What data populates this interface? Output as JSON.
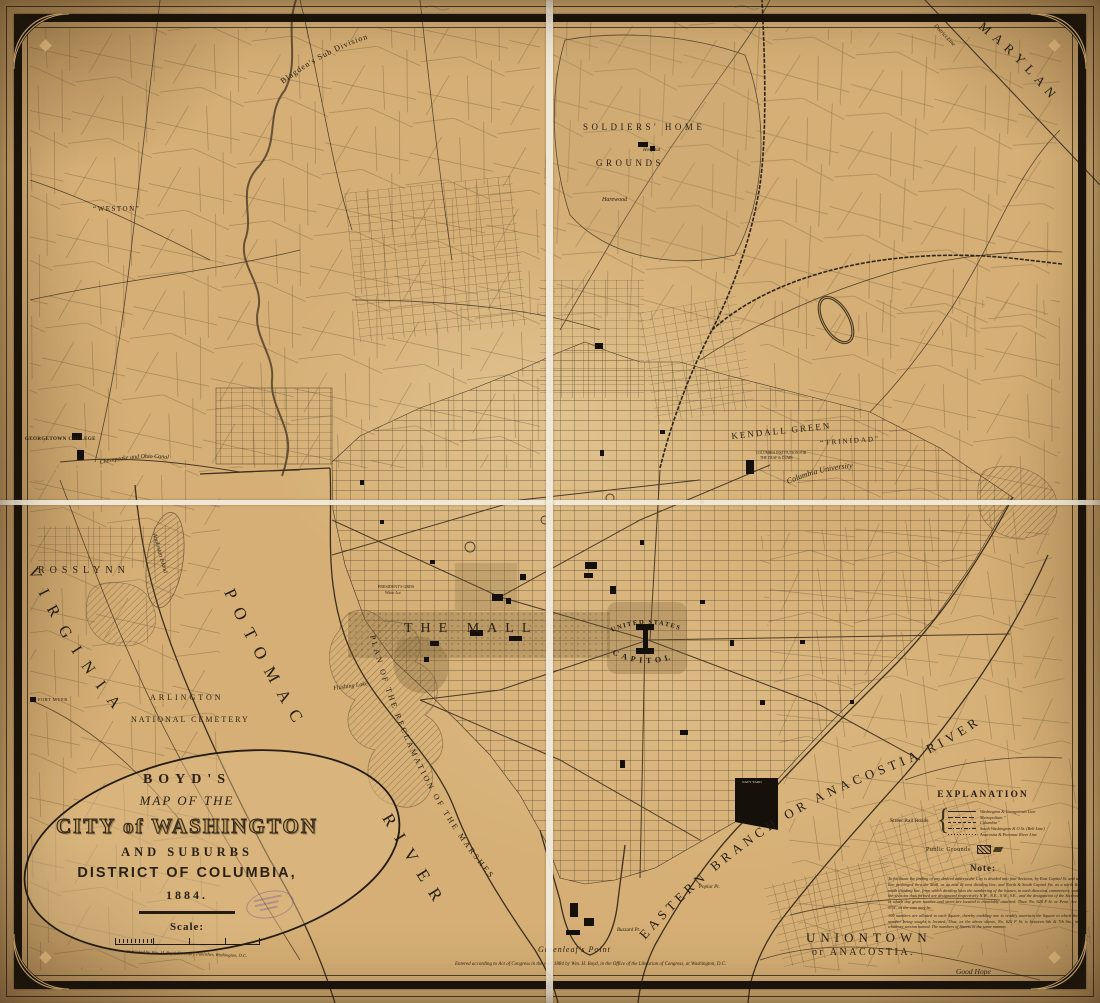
{
  "colors": {
    "paper": "#d5af75",
    "ink": "#2f2619",
    "frame": "#17120b",
    "fold_white": "#f2ebdc",
    "stamp_purple": "#6e528c"
  },
  "cartouche": {
    "boyds": "BOYD'S",
    "map_of_the": "MAP OF THE",
    "city": "CITY of WASHINGTON",
    "and_suburbs": "AND SUBURBS",
    "district": "DISTRICT OF COLUMBIA,",
    "year": "1884.",
    "scale_label": "Scale:",
    "publisher": "Published by Wm. H. Boyd, Directory Publisher, Washington, D.C."
  },
  "legend": {
    "title": "EXPLANATION",
    "rail_label": "Street Rail Roads",
    "lines": [
      "Washington & Georgetown Line",
      "Metropolitan ″",
      "Columbia ″",
      "South Washington & O St. (Belt Line)",
      "Anacostia & Potomac River Line"
    ],
    "public_grounds": "Public Grounds",
    "note_title": "Note:",
    "note_p1": "To facilitate the finding of any desired address the City is divided into four Sections, by East Capitol St. and a line prolonged thru the Mall, as an east & west dividing line, and North & South Capitol Sts. as a north & south dividing line, from which dividing lines the numbering of the houses, in each direction, commences; and the sections thus formed are designated respectively N.W., N.E., S.W., S.E., and the designation of the Section in which any given number and street are located is invariably attached. Thus: No. 620 F St. or Penn. Ave. N.W., as the case may be.",
    "note_p2": "100 numbers are allotted to each Square, thereby enabling one to readily ascertain the Square in which the number being sought is located. Thus, as the above shows, No. 620 F St. is between 6th & 7th Sts., in whatever section named. The numbers of Streets in the same manner."
  },
  "labels": {
    "maryland": "MARYLAND",
    "virginia": "VIRGINIA",
    "potomac": "POTOMAC",
    "river": "RIVER",
    "eastern_branch": "EASTERN BRANCH OR ANACOSTIA RIVER",
    "rosslynn": "ROSSLYNN",
    "arlington": "ARLINGTON",
    "national_cemetery": "NATIONAL CEMETERY",
    "fort_myer": "FORT MYER",
    "georgetown_college": "GEORGETOWN COLLEGE",
    "weston": "“WESTON”",
    "blagdens": "Blagden's Sub Division",
    "soldiers_home": "SOLDIERS' HOME",
    "grounds": "GROUNDS",
    "harewood": "Harewood",
    "hospital": "Hospital",
    "kendall_green": "KENDALL GREEN",
    "trinidad": "“TRINIDAD”",
    "columbia_university": "Columbia University",
    "deaf_institution_1": "COLUMBIA INSTITUTION FOR",
    "deaf_institution_2": "THE DEAF & DUMB",
    "united_states": "UNITED STATES",
    "capitol": "CAPITOL",
    "the_mall": "THE MALL",
    "presidents_grounds": "PRESIDENT'S GRDS",
    "white_lot": "White Lot",
    "reclamation": "PLAN OF THE RECLAMATION OF THE MARSHES",
    "flushing_lake": "Flushing Lake",
    "analostan": "Analostan Island",
    "chesapeake_canal": "Chesapeake and Ohio Canal",
    "district_line": "District Line",
    "navy_yard": "NAVY YARD",
    "greenleafs_point": "Greenleaf's Point",
    "buzzard_pt": "Buzzard Pt.",
    "poplar_pt": "Poplar Pt.",
    "uniontown": "UNIONTOWN",
    "of_anacostia": "or ANACOSTIA.",
    "good_hope": "Good Hope"
  },
  "imprint": "Entered according to Act of Congress in the year 1884 by Wm. H. Boyd, in the Office of the Librarian of Congress, at Washington, D.C."
}
